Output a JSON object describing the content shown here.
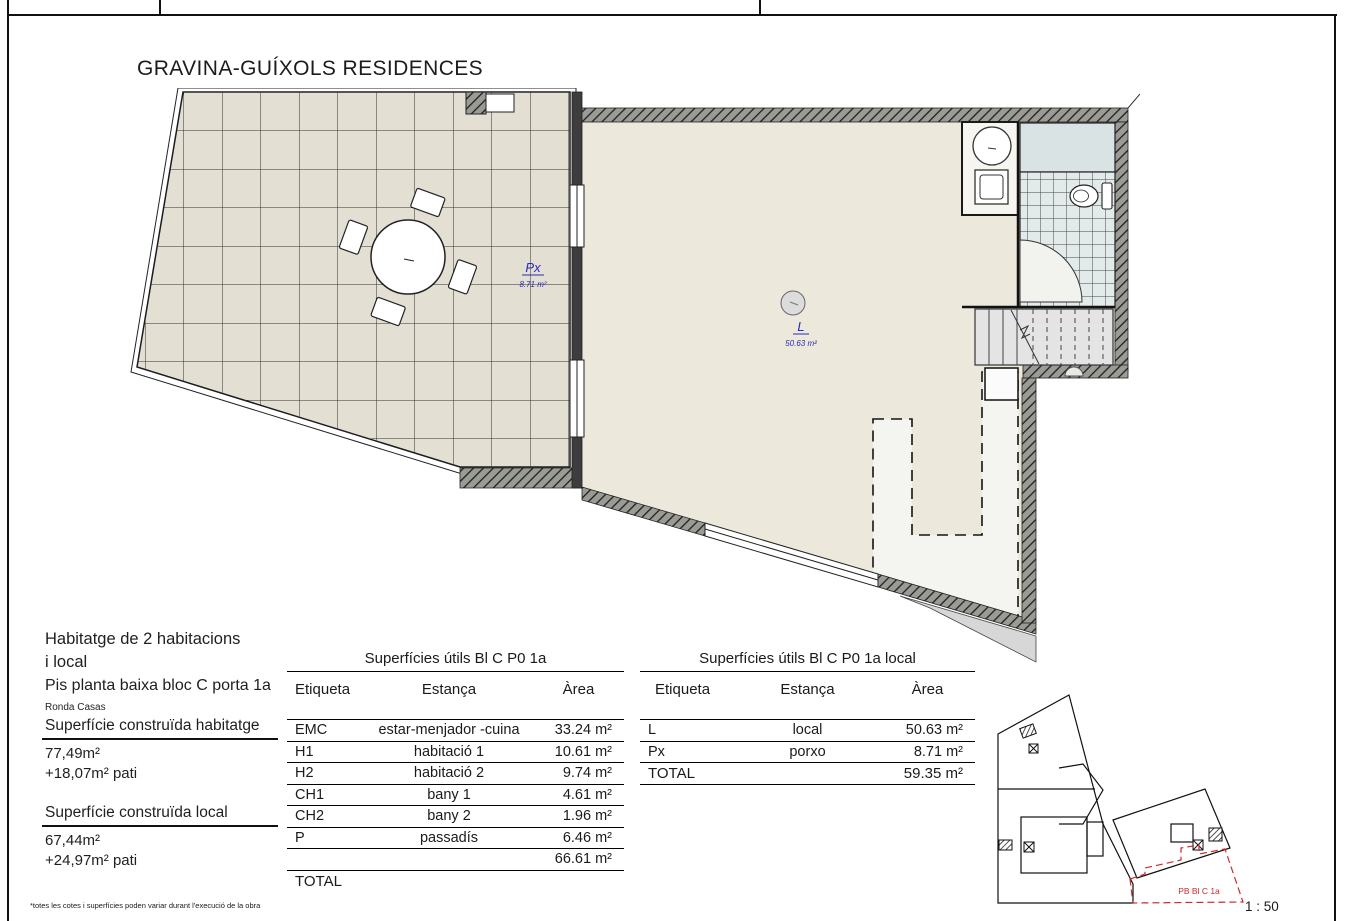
{
  "title": "GRAVINA-GUÍXOLS RESIDENCES",
  "info": {
    "heading_line1": "Habitatge de 2 habitacions",
    "heading_line2": "i local",
    "subheading": "Pis planta baixa bloc C porta 1a",
    "address": "Ronda Casas",
    "built_dwelling_label": "Superfície construïda habitatge",
    "built_dwelling_value": "77,49m²",
    "built_dwelling_patio": "+18,07m² pati",
    "built_local_label": "Superfície construïda local",
    "built_local_value": "67,44m²",
    "built_local_patio": "+24,97m² pati"
  },
  "tables": [
    {
      "title": "Superfícies útils Bl C P0 1a",
      "columns": [
        "Etiqueta",
        "Estança",
        "Àrea"
      ],
      "rows": [
        [
          "EMC",
          "estar-menjador -cuina",
          "33.24 m²"
        ],
        [
          "H1",
          "habitació 1",
          "10.61 m²"
        ],
        [
          "H2",
          "habitació 2",
          "9.74 m²"
        ],
        [
          "CH1",
          "bany 1",
          "4.61 m²"
        ],
        [
          "CH2",
          "bany 2",
          "1.96 m²"
        ],
        [
          "P",
          "passadís",
          "6.46 m²"
        ],
        [
          "",
          "",
          "66.61 m²"
        ]
      ],
      "total_label": "TOTAL",
      "total_value": ""
    },
    {
      "title": "Superfícies útils Bl C P0 1a local",
      "columns": [
        "Etiqueta",
        "Estança",
        "Àrea"
      ],
      "rows": [
        [
          "L",
          "local",
          "50.63 m²"
        ],
        [
          "Px",
          "porxo",
          "8.71 m²"
        ]
      ],
      "total_label": "TOTAL",
      "total_value": "59.35 m²"
    }
  ],
  "plan_labels": {
    "porxo_code": "Px",
    "porxo_area": "8.71 m²",
    "local_code": "L",
    "local_area": "50.63 m²"
  },
  "key_plan": {
    "unit_label": "PB Bl C 1a"
  },
  "footer": {
    "disclaimer": "*totes les cotes i superfícies poden variar durant l'execució de la obra",
    "scale": "1 : 50"
  },
  "colors": {
    "plan_label_blue": "#2a2ab8",
    "key_plan_red": "#cc2b2b",
    "patio_fill": "#e3e0d3",
    "room_fill": "#ece9dc",
    "shower_fill": "#d9e3e3"
  }
}
